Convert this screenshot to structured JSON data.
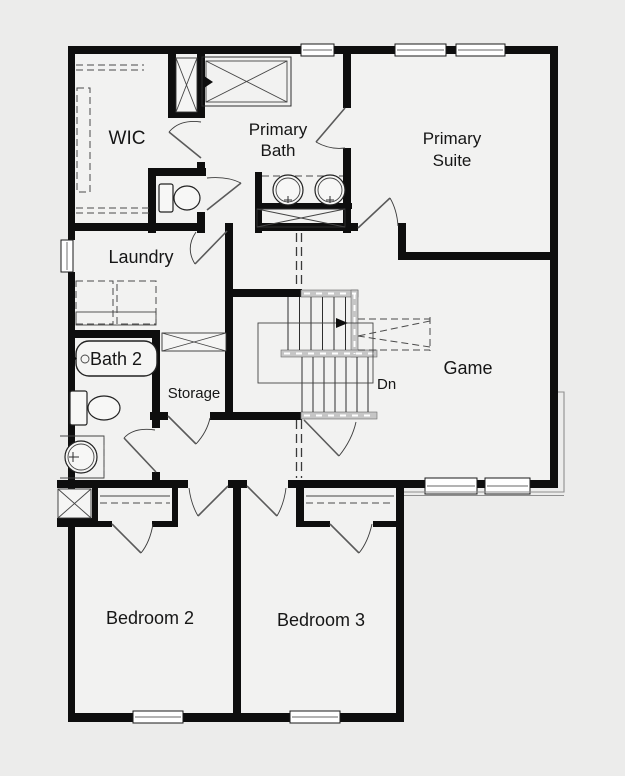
{
  "plan": {
    "colors": {
      "background": "#ececeb",
      "floor": "#f2f2f1",
      "wall": "#0e0e0e",
      "stair_rail": "#c6c6c6"
    },
    "rooms": {
      "wic": "WIC",
      "primary_bath_line1": "Primary",
      "primary_bath_line2": "Bath",
      "primary_suite_line1": "Primary",
      "primary_suite_line2": "Suite",
      "laundry": "Laundry",
      "bath2": "Bath 2",
      "storage": "Storage",
      "game": "Game",
      "bedroom2": "Bedroom 2",
      "bedroom3": "Bedroom 3"
    },
    "stairs": {
      "down_label": "Dn"
    }
  }
}
